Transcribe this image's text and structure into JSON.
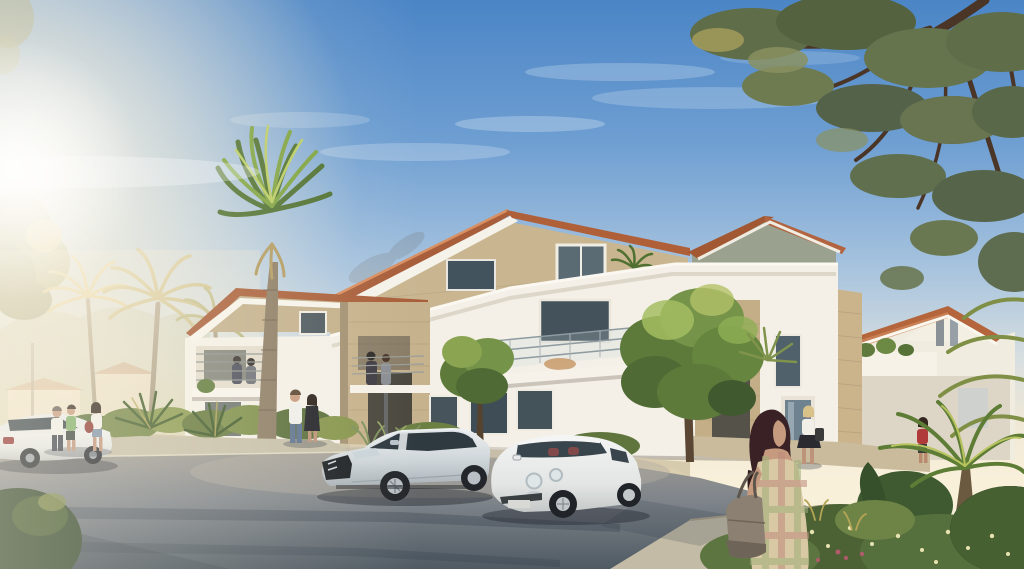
{
  "scene": {
    "type": "architectural-rendering",
    "description": "Photorealistic architectural rendering of a modern Mediterranean apartment residence at golden hour: white and beige-stone two-storey buildings with terracotta roofs and balconies, palm trees, a pine tree overhanging from the top right, a silver hatchback and a white city car parked in front, pedestrians on the sidewalk, a woman with a handbag in the foreground and lush garden planting at the lower right.",
    "time_of_day": "late-afternoon-sun-from-left",
    "vehicles": [
      "white-hatchback-partial-left",
      "silver-hatchback-ds5",
      "white-city-car-fiat500"
    ],
    "people": [
      "pedestrian-man-white-shirt",
      "pedestrian-green-top",
      "pedestrian-woman-white-top",
      "balcony-couple-left",
      "balcony-couple-center",
      "entrance-couple-man",
      "entrance-couple-woman",
      "walking-woman-blonde",
      "person-red-top",
      "foreground-woman-plaid-dress"
    ],
    "landscape": [
      "pine-tree",
      "fan-palm",
      "backlit-palms",
      "deciduous-trees",
      "flowering-shrubs",
      "planter-walls",
      "asphalt-road",
      "sidewalk"
    ]
  },
  "palette": {
    "sky_top": "#4b85c6",
    "sky_mid": "#a5c2de",
    "sky_horizon": "#f9f0da",
    "sun_glow": "#fff8e7",
    "wall_white": "#f4f0e7",
    "wall_stone": "#c9b691",
    "wall_stone_shade": "#9a8a6e",
    "roof_tile": "#a85e3a",
    "roof_tile_light": "#d98f60",
    "fascia_white": "#f6f3ec",
    "window_glass": "#44525c",
    "entrance_dark": "#4a473e",
    "planter_wall": "#d5c9ad",
    "sidewalk": "#c3bba6",
    "road_light": "#a09d96",
    "road_dark": "#4f5a63",
    "cast_shadow": "#2b3644",
    "foliage_dark": "#47602f",
    "foliage_mid": "#6b7f45",
    "foliage_light": "#93ad58",
    "palm_gold": "#c6b164",
    "pine_green": "#5f6d49",
    "trunk_brown": "#6e604c",
    "car_silver": "#d6dadd",
    "car_white": "#eceeec",
    "glass_dark": "#2e3940",
    "skin": "#c59a7e",
    "hair_dark": "#3a2126",
    "plaid_dress": "#d8c9a4",
    "bag_taupe": "#8b8072",
    "red_accent": "#8e3a34"
  }
}
